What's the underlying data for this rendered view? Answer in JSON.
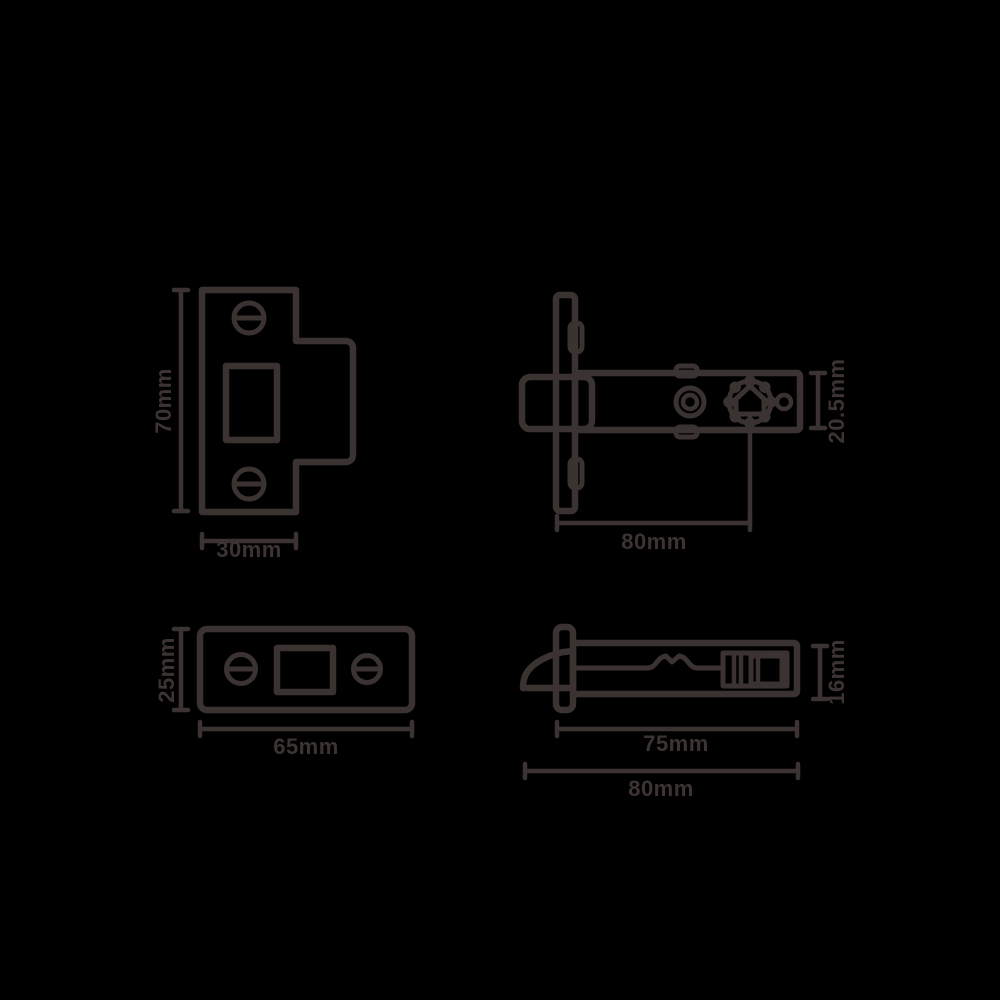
{
  "colors": {
    "background": "#000000",
    "line": "#3a3331",
    "text": "#3b3432"
  },
  "views": {
    "strike_plate_front": {
      "height_label": "70mm",
      "width_label": "30mm"
    },
    "latch_body_top": {
      "depth_label": "20.5mm",
      "backset_label": "80mm"
    },
    "faceplate_front": {
      "height_label": "25mm",
      "width_label": "65mm"
    },
    "latch_body_side": {
      "height_label": "16mm",
      "case_length_label": "75mm",
      "overall_length_label": "80mm"
    }
  }
}
